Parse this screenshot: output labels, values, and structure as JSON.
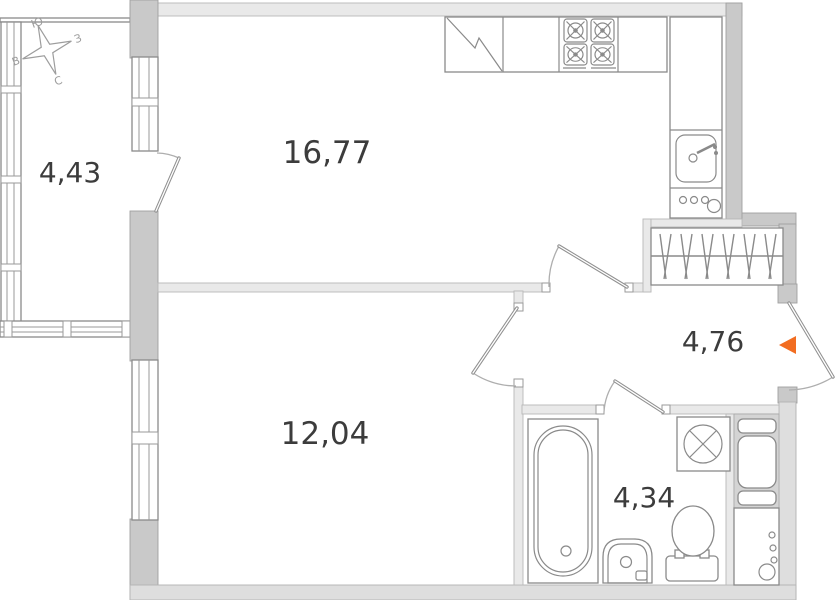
{
  "rooms": {
    "balcony": {
      "area": "4,43"
    },
    "kitchen_living": {
      "area": "16,77"
    },
    "bedroom": {
      "area": "12,04"
    },
    "hallway": {
      "area": "4,76"
    },
    "bathroom": {
      "area": "4,34"
    }
  },
  "compass": {
    "top": "Ю",
    "right": "З",
    "bottom": "С",
    "left": "В"
  },
  "colors": {
    "entrance_marker": "#F26D21",
    "wall_dark": "#c9c9c9",
    "wall_light": "#dedede",
    "line": "#8a8a8a",
    "label_text": "#3c3c3c"
  }
}
